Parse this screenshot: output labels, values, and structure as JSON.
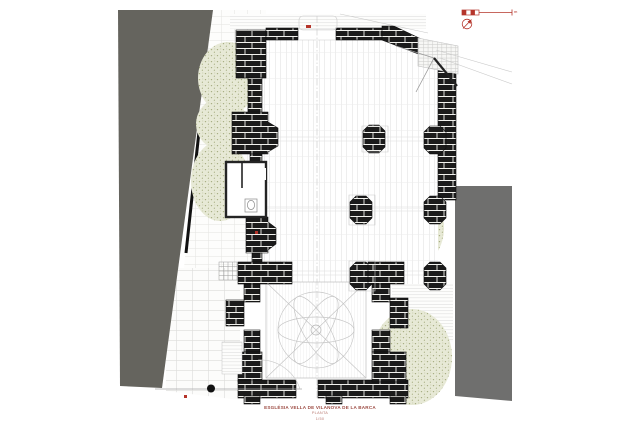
{
  "title_block": {
    "line1": "ESGLÉSIA VELLA DE VILANOVA DE LA BARCA",
    "line2": "PLANTA",
    "line3": "1/50"
  },
  "scale_bar": {
    "unit_label": "m"
  },
  "icons": {
    "north_arrow": "north-arrow-icon (red circle with arrow)",
    "scale_bar": "graphic-scale-bar",
    "tree_trunk": "tree-trunk-dot"
  },
  "colors": {
    "wall_black": "#1b1b1b",
    "neighbor_left": "#65645e",
    "neighbor_right": "#6f6f6e",
    "vegetation_base": "#e7e9d6",
    "vegetation_dot": "#a5ab7e",
    "accent_red": "#b5342a",
    "title_red": "#9c4a42",
    "paving_line": "#dedede"
  }
}
